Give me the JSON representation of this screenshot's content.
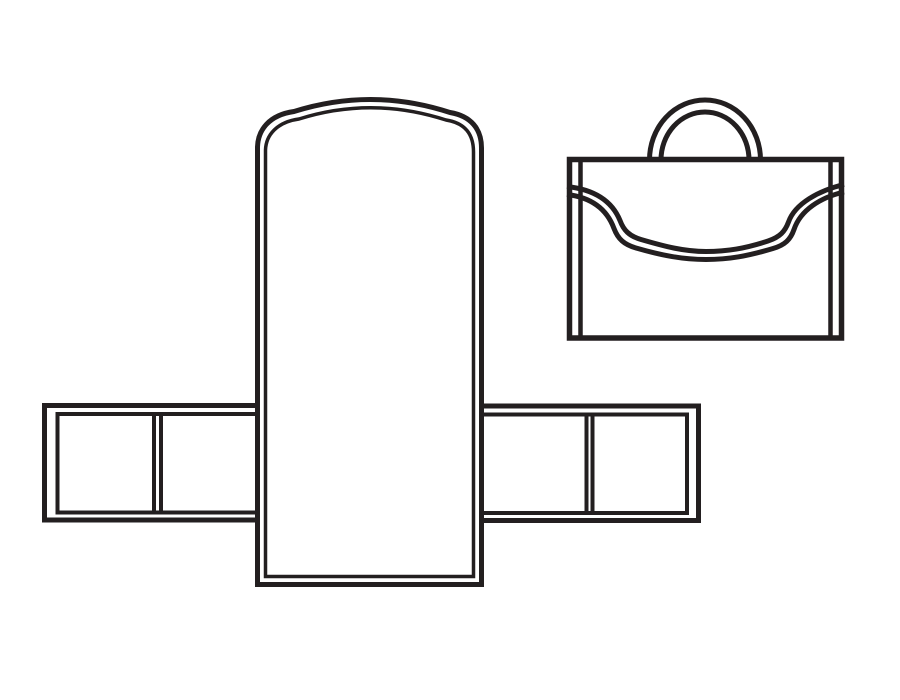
{
  "colors": {
    "line": "#231f20",
    "background": "#ffffff"
  },
  "diagram": {
    "parts": [
      {
        "name": "unfolded-template"
      },
      {
        "name": "briefcase-icon"
      }
    ]
  }
}
